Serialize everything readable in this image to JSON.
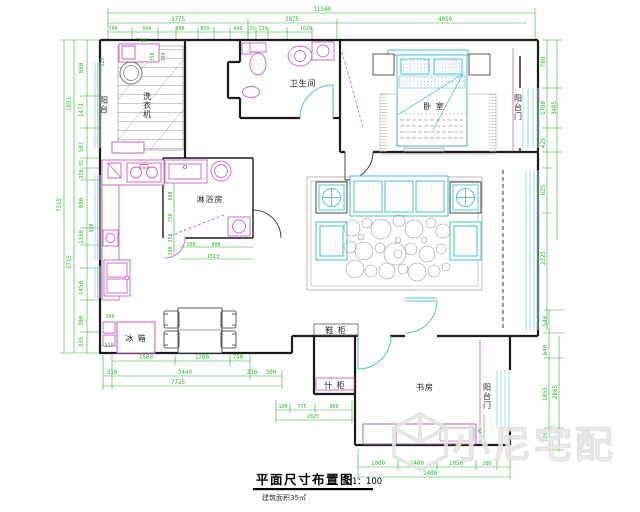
{
  "title": {
    "main": "平面尺寸布置图",
    "scale": "1：100",
    "area": "建筑面积35㎡"
  },
  "watermark": {
    "brand": "小尼宅配"
  },
  "rooms": {
    "balcony_nw": "阳台",
    "washer": "洗衣机",
    "bathroom": "卫生间",
    "bedroom": "卧 室",
    "balcony_e": "阳台门",
    "shower": "淋浴房",
    "fridge": "冰 箱",
    "shoe": "鞋 柜",
    "sundry": "什 柜",
    "study": "书房",
    "balcony_s": "阳台门"
  },
  "dims": {
    "top_total": "11340",
    "top2": [
      "3775",
      "2875",
      "4050"
    ],
    "top3": [
      "700",
      "590",
      "300",
      "850",
      "600",
      "35",
      "235",
      "1620"
    ],
    "left": [
      "860",
      "1471",
      "507",
      "55",
      "250",
      "800",
      "1130",
      "1450",
      "390",
      "335"
    ],
    "left2": [
      "1851",
      "5715"
    ],
    "left_outer": "7315",
    "left_inner": [
      "225",
      "530"
    ],
    "right_up": [
      "700",
      "1780",
      "425",
      "625",
      "2325"
    ],
    "right_up_outer": "3485",
    "right_low": [
      "540",
      "640",
      "1855",
      "520"
    ],
    "right_low_outer": "2865",
    "misc": "75",
    "bottomA": [
      "1500",
      "1200",
      "750"
    ],
    "bottomB": [
      "310",
      "3440",
      "230",
      "300"
    ],
    "bottom_total": "7725",
    "entry": [
      "190",
      "775",
      "860"
    ],
    "entry_total": "2825",
    "study": [
      "1000",
      "1400",
      "1050",
      "200"
    ],
    "study_total": "2480",
    "balcony": [
      "760",
      "350",
      "180"
    ],
    "kitchen": [
      "300",
      "310"
    ],
    "shower_v": [
      "600",
      "750",
      "350",
      "200"
    ],
    "shower_h": [
      "200",
      "900",
      "1513"
    ]
  },
  "colors": {
    "wall": "#1b1b1b",
    "dimension": "#2db52d",
    "fixture": "#c95fc9",
    "furniture": "#57c4d6",
    "window": "#9adde8",
    "watermark": "#e7e7e7"
  }
}
